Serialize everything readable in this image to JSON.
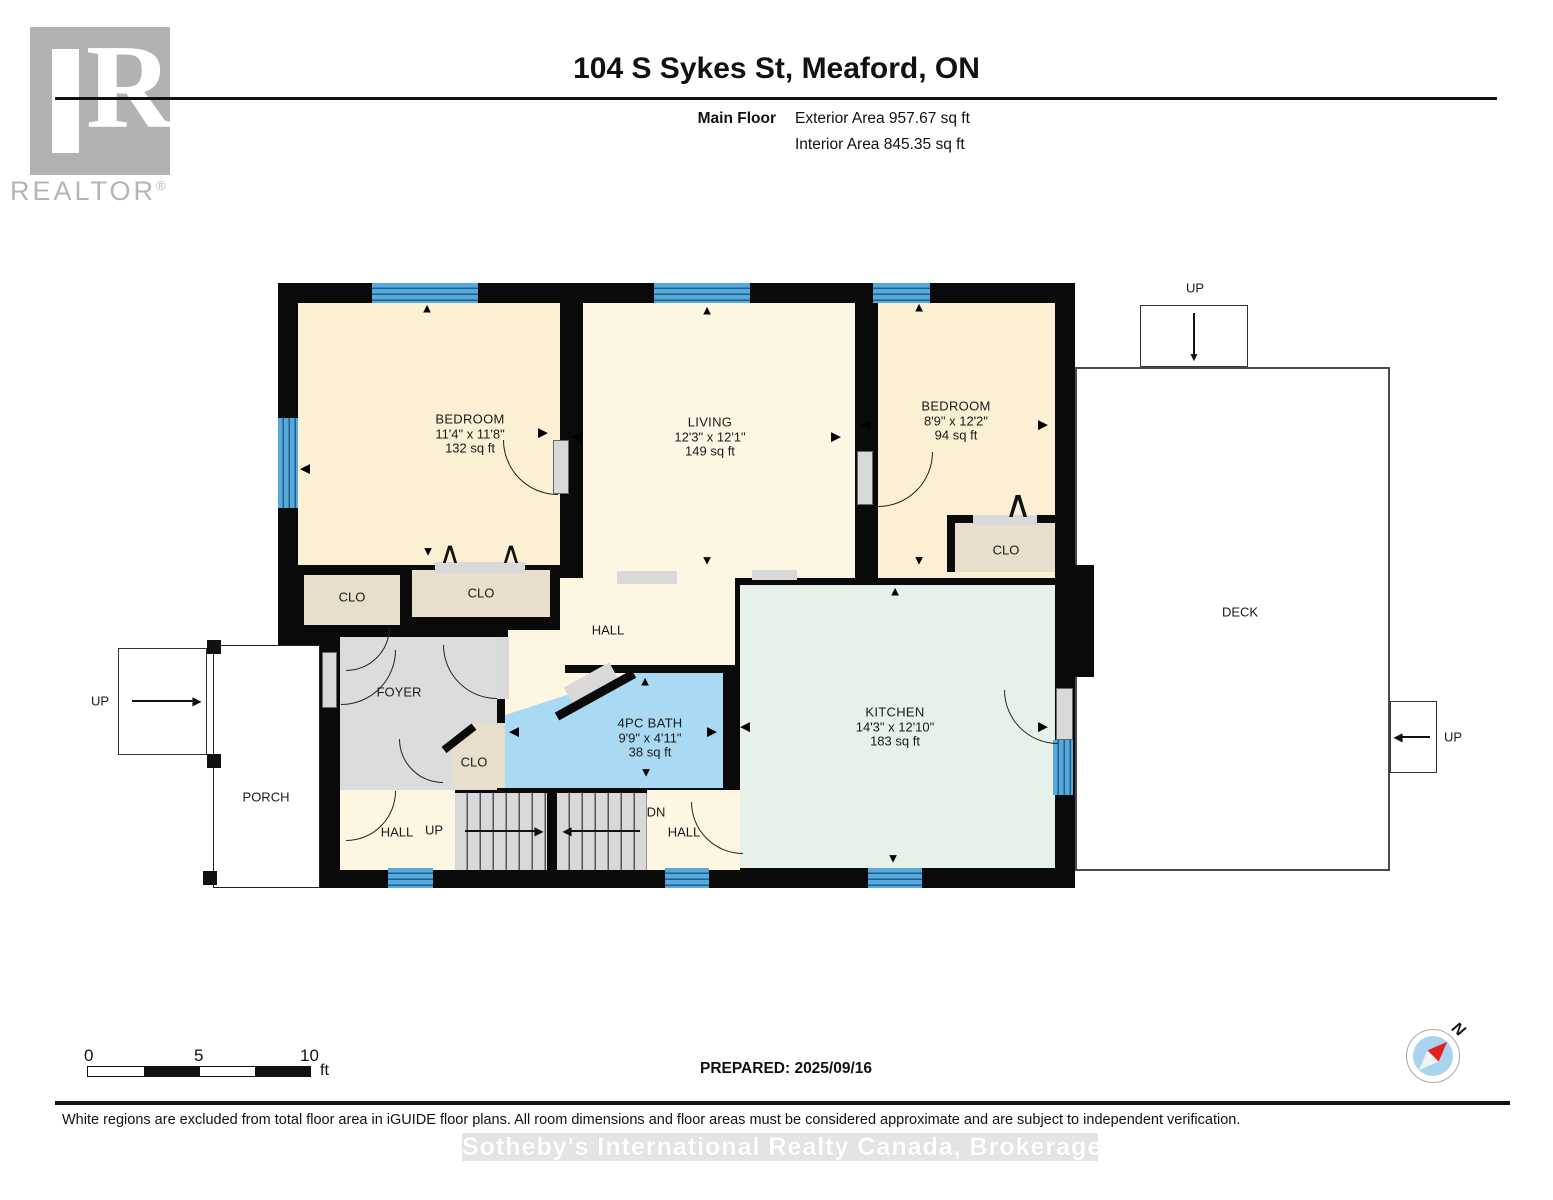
{
  "header": {
    "logo_text": "REALTOR",
    "logo_reg": "®",
    "logo_letter": "R",
    "title": "104 S Sykes St, Meaford, ON",
    "floor_label": "Main Floor",
    "exterior_area": "Exterior Area 957.67 sq ft",
    "interior_area": "Interior Area 845.35 sq ft"
  },
  "rooms": {
    "bedroom_left": {
      "name": "BEDROOM",
      "dims": "11'4\" x 11'8\"",
      "area": "132 sq ft"
    },
    "living": {
      "name": "LIVING",
      "dims": "12'3\" x 12'1\"",
      "area": "149 sq ft"
    },
    "bedroom_right": {
      "name": "BEDROOM",
      "dims": "8'9\" x 12'2\"",
      "area": "94 sq ft"
    },
    "bath": {
      "name": "4PC BATH",
      "dims": "9'9\" x 4'11\"",
      "area": "38 sq ft"
    },
    "kitchen": {
      "name": "KITCHEN",
      "dims": "14'3\" x 12'10\"",
      "area": "183 sq ft"
    },
    "closet_right": {
      "name": "CLO"
    },
    "closet_left": {
      "name": "CLO"
    },
    "closet_mid": {
      "name": "CLO"
    },
    "closet_foyer": {
      "name": "CLO"
    },
    "hall_top": {
      "name": "HALL"
    },
    "foyer": {
      "name": "FOYER"
    },
    "hall_bottom_left": {
      "name": "HALL"
    },
    "hall_bottom_right": {
      "name": "HALL"
    },
    "porch": {
      "name": "PORCH"
    },
    "deck": {
      "name": "DECK"
    }
  },
  "stairs": {
    "up_bottom": "UP",
    "dn_bottom": "DN",
    "up_porch": "UP",
    "up_deck_top": "UP",
    "up_deck_right": "UP"
  },
  "footer": {
    "scale_0": "0",
    "scale_5": "5",
    "scale_10": "10",
    "scale_unit": "ft",
    "prepared": "PREPARED: 2025/09/16",
    "compass_label": "N",
    "disclaimer": "White regions are excluded from total floor area in iGUIDE floor plans. All room dimensions and floor areas must be considered approximate and are subject to independent verification.",
    "watermark": "Sotheby's International Realty Canada, Brokerage"
  },
  "icons": {
    "pano_up": "▲",
    "pano_down": "▼",
    "pano_left": "◀",
    "pano_right": "▶",
    "bifold": "∧",
    "stair_right": "▶",
    "stair_left": "◀",
    "stair_down": "▼"
  },
  "colors": {
    "wall": "#0a0a0a",
    "roomCream": "#fbf0d3",
    "hallCream": "#fdf6e2",
    "kitchenGreen": "#e6f2e9",
    "bathBlue": "#a9d9f3",
    "closetTan": "#e7decb",
    "foyerGray": "#dcdcdc",
    "windowBlue": "#58a9db",
    "windowLine": "#1d5f8e",
    "stairGray": "#d9d9d9",
    "logoGray": "#b2b2b2"
  }
}
